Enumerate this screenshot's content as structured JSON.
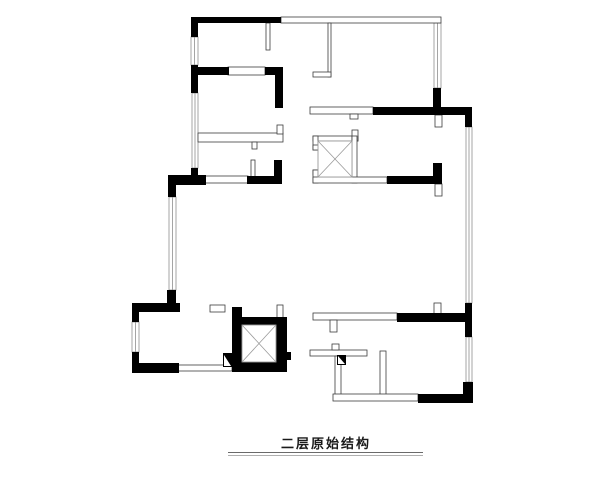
{
  "title": {
    "text": "二层原始结构"
  },
  "colors": {
    "wall_black": "#000000",
    "thin_outline": "#3c3c3c",
    "window_line": "#8f8f8f",
    "shaft_line": "#9a9a9a",
    "background": "#ffffff"
  },
  "plan": {
    "canvas": {
      "width": 600,
      "height": 480
    },
    "black_walls": [
      [
        191,
        17,
        90,
        6
      ],
      [
        191,
        17,
        7,
        20
      ],
      [
        191,
        65,
        7,
        28
      ],
      [
        191,
        67,
        38,
        8
      ],
      [
        265,
        67,
        18,
        8
      ],
      [
        275,
        67,
        8,
        41
      ],
      [
        191,
        168,
        7,
        12
      ],
      [
        168,
        175,
        38,
        10
      ],
      [
        168,
        175,
        8,
        22
      ],
      [
        247,
        176,
        35,
        8
      ],
      [
        274,
        160,
        8,
        24
      ],
      [
        167,
        290,
        9,
        21
      ],
      [
        132,
        303,
        48,
        9
      ],
      [
        132,
        303,
        7,
        19
      ],
      [
        132,
        352,
        7,
        21
      ],
      [
        132,
        363,
        47,
        10
      ],
      [
        232,
        307,
        10,
        65
      ],
      [
        242,
        317,
        40,
        8
      ],
      [
        276,
        317,
        11,
        55
      ],
      [
        232,
        362,
        55,
        10
      ],
      [
        223,
        353,
        9,
        14
      ],
      [
        283,
        352,
        8,
        8
      ],
      [
        397,
        313,
        70,
        9
      ],
      [
        465,
        303,
        7,
        34
      ],
      [
        463,
        382,
        10,
        21
      ],
      [
        418,
        394,
        54,
        9
      ],
      [
        433,
        88,
        8,
        20
      ],
      [
        373,
        107,
        99,
        8
      ],
      [
        465,
        107,
        7,
        20
      ],
      [
        387,
        176,
        53,
        8
      ],
      [
        433,
        163,
        9,
        21
      ],
      [
        337,
        355,
        9,
        10
      ]
    ],
    "thin_walls": [
      [
        281,
        17,
        160,
        6
      ],
      [
        266,
        23,
        4,
        27
      ],
      [
        328,
        23,
        3,
        54
      ],
      [
        313,
        72,
        18,
        5
      ],
      [
        198,
        133,
        85,
        9
      ],
      [
        252,
        142,
        5,
        7
      ],
      [
        277,
        125,
        6,
        9
      ],
      [
        205,
        176,
        43,
        7
      ],
      [
        251,
        160,
        4,
        17
      ],
      [
        210,
        305,
        15,
        7
      ],
      [
        277,
        305,
        6,
        13
      ],
      [
        178,
        365,
        54,
        6
      ],
      [
        313,
        313,
        84,
        7
      ],
      [
        330,
        320,
        7,
        12
      ],
      [
        434,
        303,
        7,
        11
      ],
      [
        310,
        350,
        57,
        6
      ],
      [
        332,
        344,
        7,
        6
      ],
      [
        335,
        356,
        6,
        41
      ],
      [
        380,
        351,
        6,
        44
      ],
      [
        333,
        394,
        85,
        7
      ],
      [
        310,
        107,
        63,
        7
      ],
      [
        350,
        114,
        8,
        5
      ],
      [
        435,
        184,
        7,
        12
      ],
      [
        435,
        115,
        7,
        12
      ],
      [
        228,
        67,
        37,
        8
      ],
      [
        313,
        136,
        45,
        5
      ],
      [
        352,
        130,
        6,
        11
      ],
      [
        352,
        136,
        5,
        47
      ],
      [
        313,
        136,
        5,
        14
      ],
      [
        313,
        145,
        12,
        5
      ],
      [
        313,
        170,
        12,
        5
      ],
      [
        313,
        170,
        5,
        13
      ],
      [
        313,
        177,
        74,
        6
      ]
    ],
    "windows": [
      [
        191,
        37,
        7,
        28
      ],
      [
        192,
        93,
        6,
        75
      ],
      [
        169,
        197,
        7,
        93
      ],
      [
        132,
        322,
        7,
        30
      ],
      [
        434,
        23,
        7,
        65
      ],
      [
        466,
        127,
        6,
        176
      ],
      [
        466,
        337,
        6,
        45
      ]
    ],
    "x_boxes": [
      [
        318,
        141,
        34,
        36
      ],
      [
        242,
        325,
        34,
        37
      ]
    ],
    "jamb_triangles": [
      [
        [
          224,
          355
        ],
        [
          224,
          366
        ],
        [
          231,
          366
        ]
      ],
      [
        [
          338,
          356
        ],
        [
          338,
          364
        ],
        [
          345,
          364
        ]
      ]
    ]
  }
}
